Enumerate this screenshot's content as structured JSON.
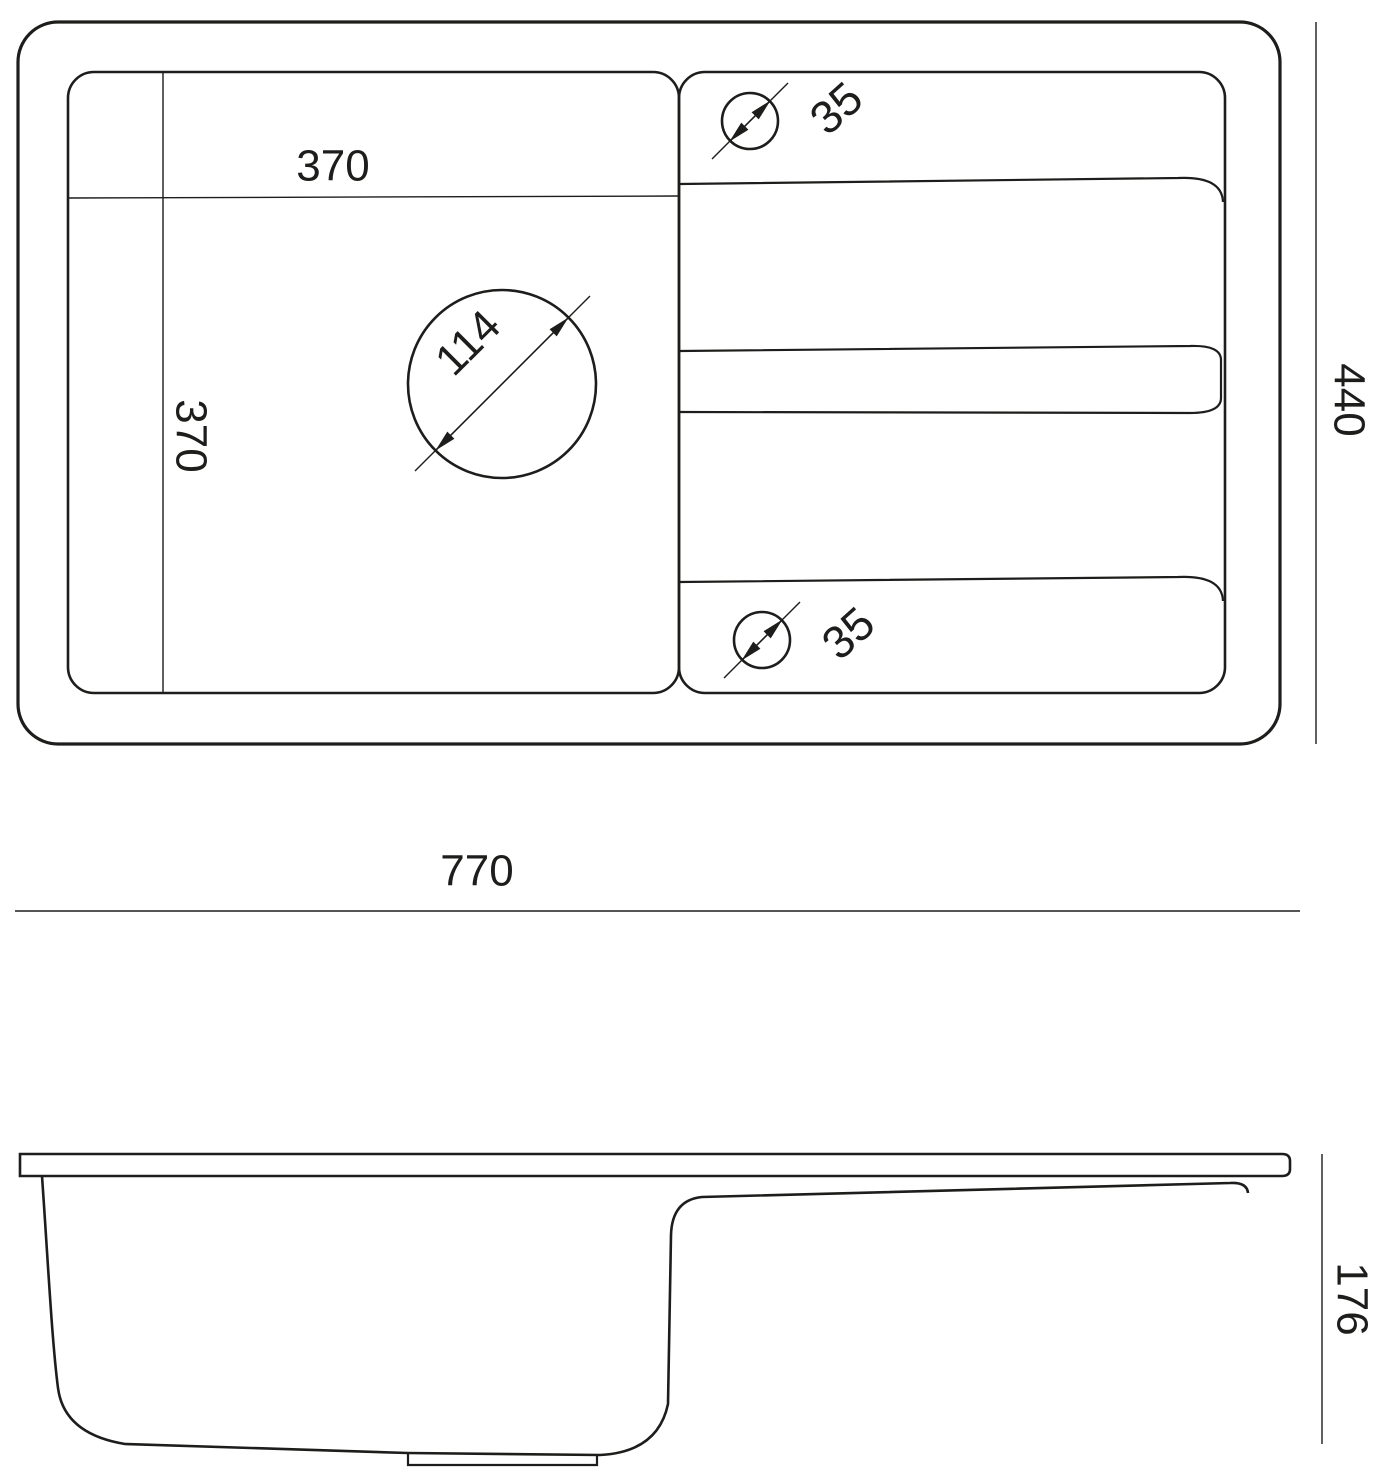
{
  "drawing_title": "Kitchen sink dimensional drawing",
  "colors": {
    "line": "#1d1d1b",
    "background": "#ffffff"
  },
  "top_view": {
    "bowl_width_label": "370",
    "bowl_depth_label": "370",
    "drain_diameter_label": "114",
    "tap_hole_top_diameter_label": "35",
    "tap_hole_bottom_diameter_label": "35",
    "overall_depth_label": "440"
  },
  "overall_width_label": "770",
  "side_view": {
    "height_label": "176"
  }
}
